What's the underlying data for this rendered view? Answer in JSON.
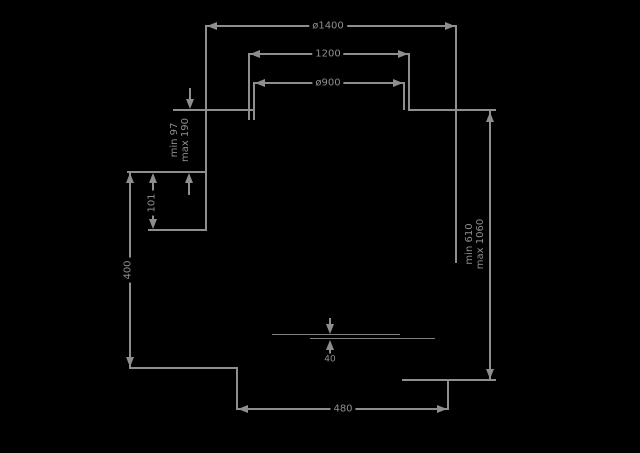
{
  "drawing": {
    "background": "#000000",
    "line_color": "#8e8e8e",
    "labels": {
      "top_outer_diameter": "ø1400",
      "top_middle_width": "1200",
      "top_inner_diameter": "ø900",
      "left_adjustable": {
        "line1": "min 97",
        "line2": "max 190"
      },
      "left_offset": "101",
      "left_height": "400",
      "right_adjustable": {
        "line1": "min 610",
        "line2": "max 1060"
      },
      "center_thickness": "40",
      "bottom_width": "480"
    }
  }
}
